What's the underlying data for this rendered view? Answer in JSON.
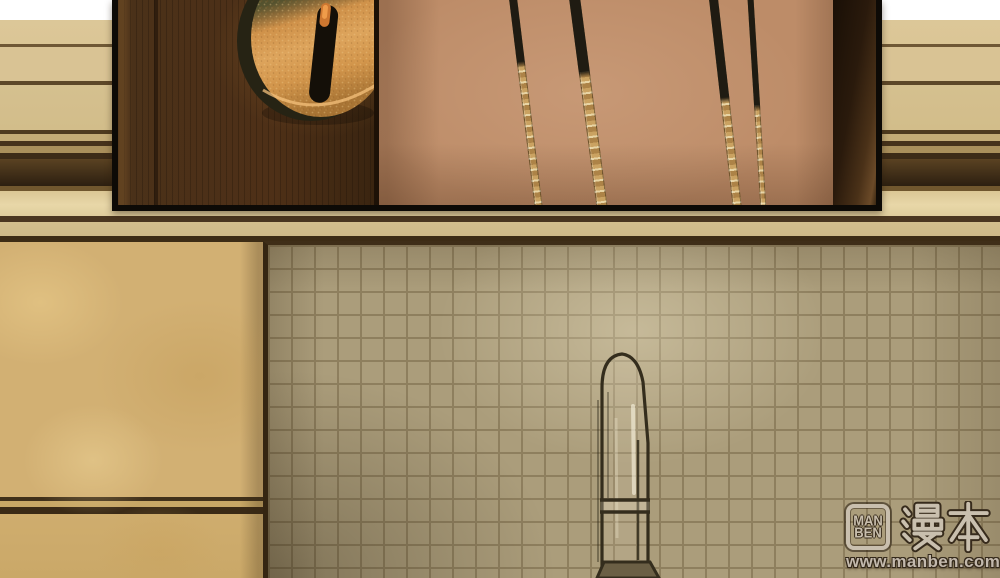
{
  "watermark": {
    "box_line1": "MAN",
    "box_line2": "BEN",
    "cjk": "漫本",
    "url": "www.manben.com"
  },
  "colors": {
    "page_bg": "#ffffff",
    "molding_beige": "#d8c392",
    "molding_trim": "#3d2c15",
    "marble": "#d0ae6f",
    "tile": "#ab9d7b",
    "tile_grout": "#8e7f5e",
    "panel_border": "#0d0a06",
    "door_wood": "#4a3119",
    "inner_wall": "#bd8c68",
    "keyhole_gold": "#d79a52",
    "keyhole_shadow": "#4e4b2a",
    "stick_dark": "#1f1b12",
    "stick_gold": "#caa261",
    "glass_line": "#342d1d",
    "logo_light": "#c9bfae",
    "logo_dark": "#372b1c"
  }
}
